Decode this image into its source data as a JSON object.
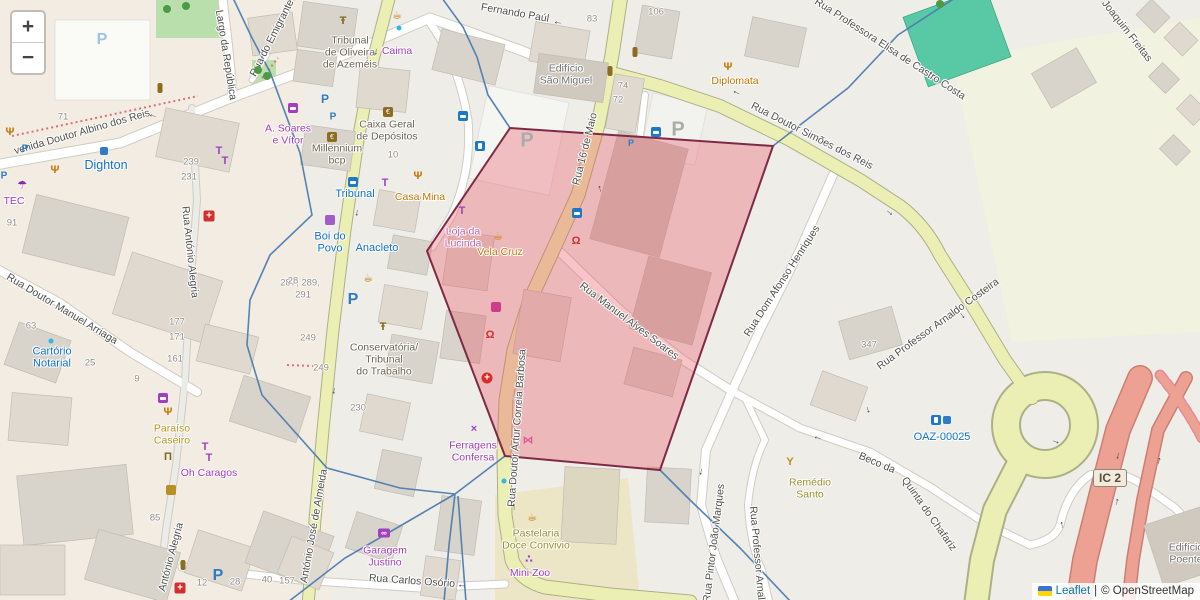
{
  "ui": {
    "zoom_in": "+",
    "zoom_out": "−",
    "attribution": {
      "leaflet": "Leaflet",
      "sep": "|",
      "osm": "© OpenStreetMap"
    }
  },
  "colors": {
    "polygon_fill": "rgba(232,82,96,0.34)",
    "polygon_stroke": "#7E2A47",
    "boundary_line": "#4C7DB0",
    "road_yellow": "#ECEFB4",
    "highway_salmon": "#EDA193",
    "teal_building": "#58C9A4"
  },
  "overlay_polygon": "510,128 773,146 660,470 505,456 427,251",
  "ic2_shield": {
    "label": "IC 2",
    "x": 1110,
    "y": 478
  },
  "streets": [
    {
      "t": "venida Doutor Albino dos Reis",
      "x": 82,
      "y": 132,
      "r": -16
    },
    {
      "t": "Largo da República",
      "x": 226,
      "y": 55,
      "r": 81
    },
    {
      "t": "Rua do Emigrante",
      "x": 272,
      "y": 38,
      "r": -63
    },
    {
      "t": "Fernando Paúl",
      "x": 515,
      "y": 13,
      "r": 10
    },
    {
      "t": "Rua 16 de Maio",
      "x": 585,
      "y": 149,
      "r": -76
    },
    {
      "t": "Rua Doutor Simões dos Reis",
      "x": 812,
      "y": 136,
      "r": 27
    },
    {
      "t": "Rua Professora Elisa de Castro Costa",
      "x": 890,
      "y": 49,
      "r": 33
    },
    {
      "t": "Joaquim Freitas",
      "x": 1127,
      "y": 31,
      "r": 52
    },
    {
      "t": "Rua Doutor Manuel Arriaga",
      "x": 62,
      "y": 309,
      "r": 31
    },
    {
      "t": "Rua António Alegria",
      "x": 190,
      "y": 252,
      "r": 84
    },
    {
      "t": "António Alegria",
      "x": 171,
      "y": 557,
      "r": -75
    },
    {
      "t": "Rua Dom Afonso Henriques",
      "x": 782,
      "y": 281,
      "r": -57
    },
    {
      "t": "Rua Pintor João Marques",
      "x": 714,
      "y": 543,
      "r": -83
    },
    {
      "t": "Rua Professor Arnal",
      "x": 757,
      "y": 553,
      "r": 85
    },
    {
      "t": "Rua Professor Arnaldo Costeira",
      "x": 938,
      "y": 324,
      "r": -36
    },
    {
      "t": "Beco da",
      "x": 877,
      "y": 463,
      "r": 23
    },
    {
      "t": "Quinta do Chafariz",
      "x": 929,
      "y": 514,
      "r": 55
    },
    {
      "t": "Rua Manuel Alves Soares",
      "x": 629,
      "y": 321,
      "r": 37
    },
    {
      "t": "Rua Doutor Artur Correia Barbosa",
      "x": 517,
      "y": 428,
      "r": -86
    },
    {
      "t": "Rua Carlos Osório",
      "x": 412,
      "y": 581,
      "r": 4
    },
    {
      "t": "António José de Almeida",
      "x": 314,
      "y": 526,
      "r": -80
    }
  ],
  "places": [
    {
      "t": "Dighton",
      "x": 106,
      "y": 165,
      "c": "blue",
      "big": true
    },
    {
      "t": "Tribunal",
      "x": 355,
      "y": 194,
      "c": "blue"
    },
    {
      "t": "Boi do\nPovo",
      "x": 330,
      "y": 243,
      "c": "blue"
    },
    {
      "t": "Anacleto",
      "x": 377,
      "y": 248,
      "c": "blue"
    },
    {
      "t": "Cartório\nNotarial",
      "x": 52,
      "y": 358,
      "c": "blue"
    },
    {
      "t": "OAZ-00025",
      "x": 942,
      "y": 437,
      "c": "blue"
    },
    {
      "t": "TEC",
      "x": 14,
      "y": 202,
      "c": "purple"
    },
    {
      "t": "Caima",
      "x": 397,
      "y": 52,
      "c": "purple"
    },
    {
      "t": "A. Soares\ne Vítor",
      "x": 288,
      "y": 135,
      "c": "purple"
    },
    {
      "t": "Garagem\nJustino",
      "x": 385,
      "y": 557,
      "c": "purple"
    },
    {
      "t": "Ferragens\nConfersa",
      "x": 473,
      "y": 452,
      "c": "purple"
    },
    {
      "t": "Mini Zoo",
      "x": 530,
      "y": 574,
      "c": "purple"
    },
    {
      "t": "Oh Caragos",
      "x": 209,
      "y": 474,
      "c": "purple"
    },
    {
      "t": "Loja da\nLucinda",
      "x": 463,
      "y": 238,
      "c": "pink"
    },
    {
      "t": "Casa Mina",
      "x": 420,
      "y": 198,
      "c": "food"
    },
    {
      "t": "Vela Cruz",
      "x": 500,
      "y": 253,
      "c": "food"
    },
    {
      "t": "Diplomata",
      "x": 735,
      "y": 82,
      "c": "food"
    },
    {
      "t": "Paraíso\nCaseiro",
      "x": 172,
      "y": 435,
      "c": "gold"
    },
    {
      "t": "Remédio\nSanto",
      "x": 810,
      "y": 489,
      "c": "khaki"
    },
    {
      "t": "Pastelaria\nDoce Convivio",
      "x": 536,
      "y": 540,
      "c": "khaki"
    },
    {
      "t": "Tribunal\nde Oliveira\nde Azeméis",
      "x": 350,
      "y": 53,
      "c": "brown"
    },
    {
      "t": "Caixa Geral\nde Depósitos",
      "x": 387,
      "y": 131,
      "c": "brown"
    },
    {
      "t": "Millennium\nbcp",
      "x": 337,
      "y": 155,
      "c": "brown"
    },
    {
      "t": "Conservatória/\nTribunal\ndo Trabalho",
      "x": 384,
      "y": 360,
      "c": "brown"
    },
    {
      "t": "Edifício\nSão Miguel",
      "x": 566,
      "y": 75,
      "c": "gray"
    },
    {
      "t": "Edifício\nPoente",
      "x": 1186,
      "y": 554,
      "c": "gray"
    }
  ],
  "numbers": [
    {
      "t": "71",
      "x": 63,
      "y": 117
    },
    {
      "t": "91",
      "x": 12,
      "y": 223
    },
    {
      "t": "63",
      "x": 31,
      "y": 326
    },
    {
      "t": "25",
      "x": 90,
      "y": 363
    },
    {
      "t": "9",
      "x": 137,
      "y": 379
    },
    {
      "t": "239",
      "x": 191,
      "y": 162
    },
    {
      "t": "231",
      "x": 189,
      "y": 177
    },
    {
      "t": "177",
      "x": 177,
      "y": 322
    },
    {
      "t": "171",
      "x": 177,
      "y": 337
    },
    {
      "t": "161",
      "x": 175,
      "y": 359
    },
    {
      "t": "287, 289,",
      "x": 300,
      "y": 283
    },
    {
      "t": "291",
      "x": 303,
      "y": 295
    },
    {
      "t": "249",
      "x": 308,
      "y": 338
    },
    {
      "t": "249",
      "x": 321,
      "y": 368
    },
    {
      "t": "230",
      "x": 358,
      "y": 408
    },
    {
      "t": "10",
      "x": 393,
      "y": 155
    },
    {
      "t": "83",
      "x": 592,
      "y": 19
    },
    {
      "t": "106",
      "x": 656,
      "y": 12
    },
    {
      "t": "74",
      "x": 623,
      "y": 86
    },
    {
      "t": "72",
      "x": 618,
      "y": 100
    },
    {
      "t": "85",
      "x": 155,
      "y": 518
    },
    {
      "t": "12",
      "x": 202,
      "y": 583
    },
    {
      "t": "28",
      "x": 235,
      "y": 582
    },
    {
      "t": "40",
      "x": 267,
      "y": 580
    },
    {
      "t": "157",
      "x": 287,
      "y": 581
    },
    {
      "t": "28",
      "x": 293,
      "y": 281
    },
    {
      "t": "347",
      "x": 869,
      "y": 345
    }
  ],
  "pois": [
    {
      "k": "pblue",
      "x": 25,
      "y": 149,
      "s": 10
    },
    {
      "k": "pblue",
      "x": 4,
      "y": 176,
      "s": 10
    },
    {
      "k": "pblue",
      "x": 325,
      "y": 99,
      "s": 12
    },
    {
      "k": "pblue",
      "x": 333,
      "y": 117,
      "s": 10
    },
    {
      "k": "pblue",
      "x": 353,
      "y": 300,
      "s": 16
    },
    {
      "k": "pblue",
      "x": 218,
      "y": 576,
      "s": 16
    },
    {
      "k": "pblue",
      "x": 631,
      "y": 143,
      "s": 9
    },
    {
      "k": "plight",
      "x": 102,
      "y": 40,
      "s": 16
    },
    {
      "k": "pgray",
      "x": 527,
      "y": 141,
      "s": 20
    },
    {
      "k": "pgray",
      "x": 678,
      "y": 130,
      "s": 20
    },
    {
      "k": "bus",
      "x": 353,
      "y": 182
    },
    {
      "k": "bus",
      "x": 463,
      "y": 116
    },
    {
      "k": "bus",
      "x": 577,
      "y": 213
    },
    {
      "k": "bus",
      "x": 656,
      "y": 132
    },
    {
      "k": "fuel",
      "x": 480,
      "y": 146
    },
    {
      "k": "fuel",
      "x": 936,
      "y": 420
    },
    {
      "k": "misc",
      "x": 947,
      "y": 420
    },
    {
      "k": "pharm",
      "x": 209,
      "y": 216
    },
    {
      "k": "pharm",
      "x": 180,
      "y": 588
    },
    {
      "k": "hosp",
      "x": 487,
      "y": 378
    },
    {
      "k": "tooth",
      "x": 490,
      "y": 335
    },
    {
      "k": "tooth",
      "x": 576,
      "y": 241
    },
    {
      "k": "cafe",
      "x": 397,
      "y": 15
    },
    {
      "k": "cafe",
      "x": 368,
      "y": 278
    },
    {
      "k": "cafe",
      "x": 532,
      "y": 517
    },
    {
      "k": "cafe",
      "x": 498,
      "y": 236
    },
    {
      "k": "goblet",
      "x": 790,
      "y": 462
    },
    {
      "k": "beer",
      "x": 171,
      "y": 490
    },
    {
      "k": "rest",
      "x": 10,
      "y": 132
    },
    {
      "k": "rest",
      "x": 55,
      "y": 170
    },
    {
      "k": "rest",
      "x": 418,
      "y": 176
    },
    {
      "k": "rest",
      "x": 728,
      "y": 67
    },
    {
      "k": "rest",
      "x": 168,
      "y": 412
    },
    {
      "k": "shirt",
      "x": 385,
      "y": 183
    },
    {
      "k": "shirt",
      "x": 462,
      "y": 211
    },
    {
      "k": "shirt",
      "x": 205,
      "y": 447
    },
    {
      "k": "shirt",
      "x": 209,
      "y": 458
    },
    {
      "k": "shirt",
      "x": 219,
      "y": 151
    },
    {
      "k": "shirt",
      "x": 225,
      "y": 161
    },
    {
      "k": "tv",
      "x": 293,
      "y": 108
    },
    {
      "k": "tv",
      "x": 163,
      "y": 398
    },
    {
      "k": "umbrella",
      "x": 22,
      "y": 185
    },
    {
      "k": "museum",
      "x": 168,
      "y": 457
    },
    {
      "k": "scales",
      "x": 343,
      "y": 21
    },
    {
      "k": "scales",
      "x": 383,
      "y": 327
    },
    {
      "k": "atm",
      "x": 388,
      "y": 112
    },
    {
      "k": "atm",
      "x": 332,
      "y": 137
    },
    {
      "k": "laundry",
      "x": 330,
      "y": 220
    },
    {
      "k": "conv",
      "x": 496,
      "y": 307
    },
    {
      "k": "fish",
      "x": 528,
      "y": 440
    },
    {
      "k": "paw",
      "x": 529,
      "y": 559
    },
    {
      "k": "car",
      "x": 384,
      "y": 533
    },
    {
      "k": "tools",
      "x": 474,
      "y": 429
    },
    {
      "k": "light",
      "x": 160,
      "y": 88
    },
    {
      "k": "light",
      "x": 635,
      "y": 52
    },
    {
      "k": "light",
      "x": 610,
      "y": 71
    },
    {
      "k": "light",
      "x": 183,
      "y": 565
    },
    {
      "k": "dot",
      "x": 399,
      "y": 28
    },
    {
      "k": "dot",
      "x": 51,
      "y": 341
    },
    {
      "k": "dot",
      "x": 504,
      "y": 481
    },
    {
      "k": "misc",
      "x": 104,
      "y": 151
    },
    {
      "k": "tree",
      "x": 167,
      "y": 9
    },
    {
      "k": "tree",
      "x": 186,
      "y": 6
    },
    {
      "k": "tree",
      "x": 258,
      "y": 70
    },
    {
      "k": "tree",
      "x": 267,
      "y": 76
    },
    {
      "k": "tree",
      "x": 940,
      "y": 4
    }
  ],
  "arrows": [
    {
      "g": "←",
      "x": 153,
      "y": 115,
      "r": 12
    },
    {
      "g": "←",
      "x": 558,
      "y": 22,
      "r": 8
    },
    {
      "g": "←",
      "x": 737,
      "y": 92,
      "r": 25
    },
    {
      "g": "←",
      "x": 462,
      "y": 585,
      "r": 3
    },
    {
      "g": "↓",
      "x": 376,
      "y": 52,
      "r": 5
    },
    {
      "g": "↓",
      "x": 357,
      "y": 213,
      "r": 5
    },
    {
      "g": "↓",
      "x": 334,
      "y": 391,
      "r": 5
    },
    {
      "g": "↑",
      "x": 600,
      "y": 189,
      "r": -14
    },
    {
      "g": "↑",
      "x": 514,
      "y": 507,
      "r": -4
    },
    {
      "g": "→",
      "x": 890,
      "y": 212,
      "r": 40
    },
    {
      "g": "→",
      "x": 963,
      "y": 315,
      "r": 55
    },
    {
      "g": "↓",
      "x": 868,
      "y": 410,
      "r": -18
    },
    {
      "g": "↓",
      "x": 1118,
      "y": 456,
      "r": 8
    },
    {
      "g": "↑",
      "x": 1117,
      "y": 502,
      "r": 8
    },
    {
      "g": "↑",
      "x": 1159,
      "y": 461,
      "r": 10
    },
    {
      "g": "→",
      "x": 1056,
      "y": 441,
      "r": 20
    },
    {
      "g": "↑",
      "x": 1062,
      "y": 525,
      "r": -8
    },
    {
      "g": "↓",
      "x": 701,
      "y": 472,
      "r": 10
    },
    {
      "g": "←",
      "x": 818,
      "y": 437,
      "r": 15
    }
  ]
}
